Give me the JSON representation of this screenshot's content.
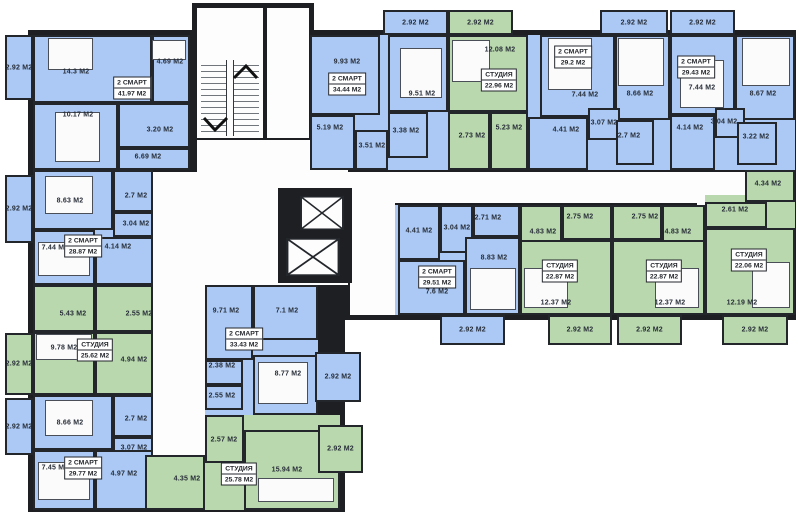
{
  "colors": {
    "two_room_fill": "#abc9f4",
    "studio_fill": "#b9d8ad",
    "wall": "#1d1f23",
    "background": "#ffffff",
    "label_text": "#272d38"
  },
  "unit": "М2",
  "apartments": [
    {
      "type": "2 СМАРТ",
      "area": "41.97 М2",
      "x": 132,
      "y": 88
    },
    {
      "type": "2 СМАРТ",
      "area": "34.44 М2",
      "x": 347,
      "y": 84
    },
    {
      "type": "СТУДИЯ",
      "area": "22.96 М2",
      "x": 499,
      "y": 80
    },
    {
      "type": "2 СМАРТ",
      "area": "29.2 М2",
      "x": 573,
      "y": 57
    },
    {
      "type": "2 СМАРТ",
      "area": "29.43 М2",
      "x": 696,
      "y": 67
    },
    {
      "type": "2 СМАРТ",
      "area": "28.87 М2",
      "x": 83,
      "y": 246
    },
    {
      "type": "СТУДИЯ",
      "area": "25.62 М2",
      "x": 95,
      "y": 350
    },
    {
      "type": "2 СМАРТ",
      "area": "29.77 М2",
      "x": 83,
      "y": 468
    },
    {
      "type": "2 СМАРТ",
      "area": "33.43 М2",
      "x": 244,
      "y": 339
    },
    {
      "type": "СТУДИЯ",
      "area": "25.78 М2",
      "x": 239,
      "y": 474
    },
    {
      "type": "2 СМАРТ",
      "area": "29.51 М2",
      "x": 437,
      "y": 277
    },
    {
      "type": "СТУДИЯ",
      "area": "22.87 М2",
      "x": 560,
      "y": 271
    },
    {
      "type": "СТУДИЯ",
      "area": "22.87 М2",
      "x": 664,
      "y": 271
    },
    {
      "type": "СТУДИЯ",
      "area": "22.06 М2",
      "x": 749,
      "y": 260
    }
  ],
  "rooms": [
    {
      "label": "2.92 М2",
      "x": 5,
      "y": 35,
      "w": 28,
      "h": 65,
      "c": "b",
      "balcony": true
    },
    {
      "label": "14.3 М2",
      "x": 33,
      "y": 35,
      "w": 119,
      "h": 68,
      "c": "b",
      "lx": 76,
      "ly": 72
    },
    {
      "label": "4.69 М2",
      "x": 152,
      "y": 35,
      "w": 38,
      "h": 68,
      "c": "b",
      "lx": 170,
      "ly": 62
    },
    {
      "label": "10.17 М2",
      "x": 33,
      "y": 103,
      "w": 85,
      "h": 67,
      "c": "b",
      "lx": 78,
      "ly": 115
    },
    {
      "label": "3.20 М2",
      "x": 118,
      "y": 103,
      "w": 72,
      "h": 45,
      "c": "b",
      "lx": 160,
      "ly": 130
    },
    {
      "label": "6.69 М2",
      "x": 118,
      "y": 148,
      "w": 72,
      "h": 22,
      "c": "b",
      "lx": 148,
      "ly": 157
    },
    {
      "label": "2.92 М2",
      "x": 383,
      "y": 10,
      "w": 65,
      "h": 25,
      "c": "b",
      "balcony": true
    },
    {
      "label": "9.93 М2",
      "x": 310,
      "y": 35,
      "w": 70,
      "h": 80,
      "c": "b",
      "lx": 347,
      "ly": 62
    },
    {
      "label": "5.19 М2",
      "x": 310,
      "y": 115,
      "w": 45,
      "h": 55,
      "c": "b",
      "lx": 330,
      "ly": 128
    },
    {
      "label": "3.51 М2",
      "x": 355,
      "y": 130,
      "w": 33,
      "h": 40,
      "c": "b",
      "lx": 372,
      "ly": 146
    },
    {
      "label": "3.38 М2",
      "x": 388,
      "y": 112,
      "w": 40,
      "h": 46,
      "c": "b",
      "lx": 406,
      "ly": 131
    },
    {
      "label": "9.51 М2",
      "x": 388,
      "y": 35,
      "w": 60,
      "h": 77,
      "c": "b",
      "lx": 422,
      "ly": 94
    },
    {
      "label": "2.92 М2",
      "x": 448,
      "y": 10,
      "w": 65,
      "h": 25,
      "c": "g",
      "balcony": true
    },
    {
      "label": "12.08 М2",
      "x": 448,
      "y": 35,
      "w": 80,
      "h": 77,
      "c": "g",
      "lx": 500,
      "ly": 50
    },
    {
      "label": "2.73 М2",
      "x": 448,
      "y": 112,
      "w": 42,
      "h": 58,
      "c": "g",
      "lx": 472,
      "ly": 136
    },
    {
      "label": "5.23 М2",
      "x": 490,
      "y": 112,
      "w": 38,
      "h": 58,
      "c": "g",
      "lx": 509,
      "ly": 128
    },
    {
      "label": "2.92 М2",
      "x": 600,
      "y": 10,
      "w": 68,
      "h": 25,
      "c": "b",
      "balcony": true
    },
    {
      "label": "7.44 М2",
      "x": 540,
      "y": 35,
      "w": 75,
      "h": 82,
      "c": "b",
      "lx": 585,
      "ly": 95
    },
    {
      "label": "8.66 М2",
      "x": 615,
      "y": 35,
      "w": 55,
      "h": 85,
      "c": "b",
      "lx": 640,
      "ly": 94
    },
    {
      "label": "4.41 М2",
      "x": 528,
      "y": 117,
      "w": 60,
      "h": 53,
      "c": "b",
      "lx": 566,
      "ly": 130
    },
    {
      "label": "3.07 М2",
      "x": 588,
      "y": 108,
      "w": 32,
      "h": 32,
      "c": "b",
      "lx": 604,
      "ly": 123
    },
    {
      "label": "2.7 М2",
      "x": 616,
      "y": 120,
      "w": 38,
      "h": 45,
      "c": "b",
      "lx": 629,
      "ly": 136
    },
    {
      "label": "2.92 М2",
      "x": 670,
      "y": 10,
      "w": 65,
      "h": 25,
      "c": "b",
      "balcony": true
    },
    {
      "label": "7.44 М2",
      "x": 670,
      "y": 35,
      "w": 65,
      "h": 80,
      "c": "b",
      "lx": 702,
      "ly": 88
    },
    {
      "label": "8.67 М2",
      "x": 735,
      "y": 35,
      "w": 60,
      "h": 85,
      "c": "b",
      "lx": 763,
      "ly": 94
    },
    {
      "label": "4.14 М2",
      "x": 670,
      "y": 115,
      "w": 45,
      "h": 55,
      "c": "b",
      "lx": 690,
      "ly": 128
    },
    {
      "label": "3.04 М2",
      "x": 715,
      "y": 108,
      "w": 30,
      "h": 30,
      "c": "b",
      "lx": 724,
      "ly": 122
    },
    {
      "label": "3.22 М2",
      "x": 737,
      "y": 122,
      "w": 40,
      "h": 43,
      "c": "b",
      "lx": 756,
      "ly": 137
    },
    {
      "label": "2.92 М2",
      "x": 5,
      "y": 175,
      "w": 28,
      "h": 68,
      "c": "b",
      "balcony": true
    },
    {
      "label": "8.63 М2",
      "x": 33,
      "y": 170,
      "w": 80,
      "h": 60,
      "c": "b",
      "lx": 70,
      "ly": 201
    },
    {
      "label": "2.7 М2",
      "x": 113,
      "y": 170,
      "w": 40,
      "h": 42,
      "c": "b",
      "lx": 136,
      "ly": 196
    },
    {
      "label": "3.04 М2",
      "x": 113,
      "y": 212,
      "w": 40,
      "h": 25,
      "c": "b",
      "lx": 136,
      "ly": 224
    },
    {
      "label": "7.44 М2",
      "x": 33,
      "y": 230,
      "w": 62,
      "h": 55,
      "c": "b",
      "lx": 55,
      "ly": 248
    },
    {
      "label": "4.14 М2",
      "x": 95,
      "y": 237,
      "w": 58,
      "h": 48,
      "c": "b",
      "lx": 118,
      "ly": 247
    },
    {
      "label": "5.43 М2",
      "x": 33,
      "y": 285,
      "w": 62,
      "h": 47,
      "c": "g",
      "lx": 73,
      "ly": 314
    },
    {
      "label": "2.55 М2",
      "x": 95,
      "y": 285,
      "w": 58,
      "h": 47,
      "c": "g",
      "lx": 139,
      "ly": 314
    },
    {
      "label": "2.92 М2",
      "x": 5,
      "y": 333,
      "w": 28,
      "h": 62,
      "c": "g",
      "balcony": true
    },
    {
      "label": "9.78 М2",
      "x": 33,
      "y": 332,
      "w": 62,
      "h": 63,
      "c": "g",
      "lx": 64,
      "ly": 348
    },
    {
      "label": "4.94 М2",
      "x": 95,
      "y": 332,
      "w": 58,
      "h": 63,
      "c": "g",
      "lx": 134,
      "ly": 360
    },
    {
      "label": "2.92 М2",
      "x": 5,
      "y": 398,
      "w": 28,
      "h": 57,
      "c": "b",
      "balcony": true
    },
    {
      "label": "8.66 М2",
      "x": 33,
      "y": 395,
      "w": 80,
      "h": 55,
      "c": "b",
      "lx": 70,
      "ly": 423
    },
    {
      "label": "2.7 М2",
      "x": 113,
      "y": 395,
      "w": 40,
      "h": 42,
      "c": "b",
      "lx": 136,
      "ly": 419
    },
    {
      "label": "3.07 М2",
      "x": 113,
      "y": 437,
      "w": 40,
      "h": 26,
      "c": "b",
      "lx": 134,
      "ly": 448
    },
    {
      "label": "7.45 М2",
      "x": 33,
      "y": 450,
      "w": 62,
      "h": 60,
      "c": "b",
      "lx": 55,
      "ly": 468
    },
    {
      "label": "4.97 М2",
      "x": 95,
      "y": 450,
      "w": 58,
      "h": 60,
      "c": "b",
      "lx": 124,
      "ly": 474
    },
    {
      "label": "9.71 М2",
      "x": 205,
      "y": 285,
      "w": 48,
      "h": 75,
      "c": "b",
      "lx": 226,
      "ly": 311
    },
    {
      "label": "7.1 М2",
      "x": 253,
      "y": 285,
      "w": 65,
      "h": 55,
      "c": "b",
      "lx": 287,
      "ly": 311
    },
    {
      "label": "2.38 М2",
      "x": 205,
      "y": 360,
      "w": 38,
      "h": 25,
      "c": "b",
      "lx": 222,
      "ly": 366
    },
    {
      "label": "2.55 М2",
      "x": 205,
      "y": 385,
      "w": 38,
      "h": 25,
      "c": "b",
      "lx": 222,
      "ly": 396
    },
    {
      "label": "8.77 М2",
      "x": 253,
      "y": 355,
      "w": 65,
      "h": 60,
      "c": "b",
      "lx": 288,
      "ly": 374
    },
    {
      "label": "2.92 М2",
      "x": 315,
      "y": 352,
      "w": 46,
      "h": 50,
      "c": "b",
      "balcony": true
    },
    {
      "label": "2.57 М2",
      "x": 205,
      "y": 415,
      "w": 39,
      "h": 48,
      "c": "g",
      "lx": 224,
      "ly": 440
    },
    {
      "label": "15.94 М2",
      "x": 244,
      "y": 430,
      "w": 96,
      "h": 80,
      "c": "g",
      "lx": 287,
      "ly": 470
    },
    {
      "label": "2.92 М2",
      "x": 318,
      "y": 425,
      "w": 45,
      "h": 48,
      "c": "g",
      "balcony": true
    },
    {
      "label": "4.35 М2",
      "x": 145,
      "y": 455,
      "w": 60,
      "h": 55,
      "c": "g",
      "lx": 187,
      "ly": 479
    },
    {
      "label": "4.41 М2",
      "x": 398,
      "y": 205,
      "w": 42,
      "h": 55,
      "c": "b",
      "lx": 419,
      "ly": 231
    },
    {
      "label": "3.04 М2",
      "x": 440,
      "y": 205,
      "w": 33,
      "h": 48,
      "c": "b",
      "lx": 457,
      "ly": 228
    },
    {
      "label": "2.71 М2",
      "x": 473,
      "y": 205,
      "w": 47,
      "h": 32,
      "c": "b",
      "lx": 488,
      "ly": 218
    },
    {
      "label": "8.83 М2",
      "x": 465,
      "y": 237,
      "w": 55,
      "h": 78,
      "c": "b",
      "lx": 494,
      "ly": 258
    },
    {
      "label": "7.6 М2",
      "x": 398,
      "y": 260,
      "w": 67,
      "h": 55,
      "c": "b",
      "lx": 437,
      "ly": 292
    },
    {
      "label": "2.92 М2",
      "x": 440,
      "y": 315,
      "w": 65,
      "h": 30,
      "c": "b",
      "balcony": true
    },
    {
      "label": "4.83 М2",
      "x": 520,
      "y": 205,
      "w": 42,
      "h": 65,
      "c": "g",
      "lx": 543,
      "ly": 232
    },
    {
      "label": "2.75 М2",
      "x": 562,
      "y": 205,
      "w": 50,
      "h": 35,
      "c": "g",
      "lx": 580,
      "ly": 217
    },
    {
      "label": "12.37 М2",
      "x": 520,
      "y": 240,
      "w": 92,
      "h": 75,
      "c": "g",
      "lx": 556,
      "ly": 303
    },
    {
      "label": "2.92 М2",
      "x": 548,
      "y": 315,
      "w": 64,
      "h": 30,
      "c": "g",
      "balcony": true
    },
    {
      "label": "2.75 М2",
      "x": 612,
      "y": 205,
      "w": 50,
      "h": 35,
      "c": "g",
      "lx": 645,
      "ly": 217
    },
    {
      "label": "4.83 М2",
      "x": 662,
      "y": 205,
      "w": 43,
      "h": 65,
      "c": "g",
      "lx": 678,
      "ly": 232
    },
    {
      "label": "12.37 М2",
      "x": 612,
      "y": 240,
      "w": 93,
      "h": 75,
      "c": "g",
      "lx": 670,
      "ly": 303
    },
    {
      "label": "2.92 М2",
      "x": 617,
      "y": 315,
      "w": 65,
      "h": 30,
      "c": "g",
      "balcony": true
    },
    {
      "label": "4.34 М2",
      "x": 745,
      "y": 170,
      "w": 50,
      "h": 32,
      "c": "g",
      "lx": 768,
      "ly": 184
    },
    {
      "label": "2.61 М2",
      "x": 705,
      "y": 202,
      "w": 62,
      "h": 26,
      "c": "g",
      "lx": 735,
      "ly": 210
    },
    {
      "label": "12.19 М2",
      "x": 705,
      "y": 228,
      "w": 90,
      "h": 87,
      "c": "g",
      "lx": 742,
      "ly": 303
    },
    {
      "label": "2.92 М2",
      "x": 722,
      "y": 315,
      "w": 66,
      "h": 30,
      "c": "g",
      "balcony": true
    }
  ],
  "apartment_blocks": [
    {
      "x": 33,
      "y": 35,
      "w": 157,
      "h": 135,
      "c": "b"
    },
    {
      "x": 310,
      "y": 35,
      "w": 138,
      "h": 135,
      "c": "b"
    },
    {
      "x": 448,
      "y": 35,
      "w": 80,
      "h": 135,
      "c": "g"
    },
    {
      "x": 528,
      "y": 35,
      "w": 142,
      "h": 135,
      "c": "b"
    },
    {
      "x": 670,
      "y": 35,
      "w": 125,
      "h": 135,
      "c": "b"
    },
    {
      "x": 33,
      "y": 170,
      "w": 120,
      "h": 115,
      "c": "b"
    },
    {
      "x": 33,
      "y": 285,
      "w": 120,
      "h": 110,
      "c": "g"
    },
    {
      "x": 33,
      "y": 395,
      "w": 120,
      "h": 115,
      "c": "b"
    },
    {
      "x": 205,
      "y": 285,
      "w": 113,
      "h": 130,
      "c": "b"
    },
    {
      "x": 205,
      "y": 415,
      "w": 135,
      "h": 95,
      "c": "g"
    },
    {
      "x": 395,
      "y": 205,
      "w": 125,
      "h": 110,
      "c": "b"
    },
    {
      "x": 520,
      "y": 205,
      "w": 92,
      "h": 110,
      "c": "g"
    },
    {
      "x": 612,
      "y": 205,
      "w": 93,
      "h": 110,
      "c": "g"
    },
    {
      "x": 705,
      "y": 195,
      "w": 90,
      "h": 120,
      "c": "g"
    }
  ],
  "structure": {
    "outer_walls": [
      {
        "x": 28,
        "y": 30,
        "w": 768,
        "h": 290
      },
      {
        "x": 28,
        "y": 170,
        "w": 177,
        "h": 342
      },
      {
        "x": 200,
        "y": 283,
        "w": 145,
        "h": 229
      },
      {
        "x": 192,
        "y": 3,
        "w": 76,
        "h": 140
      },
      {
        "x": 262,
        "y": 3,
        "w": 52,
        "h": 140
      }
    ],
    "corridors": [
      {
        "x": 197,
        "y": 8,
        "w": 66,
        "h": 130
      },
      {
        "x": 267,
        "y": 8,
        "w": 42,
        "h": 130
      },
      {
        "x": 153,
        "y": 172,
        "w": 52,
        "h": 283
      },
      {
        "x": 197,
        "y": 140,
        "w": 151,
        "h": 145
      },
      {
        "x": 348,
        "y": 172,
        "w": 398,
        "h": 31
      },
      {
        "x": 350,
        "y": 203,
        "w": 45,
        "h": 112
      },
      {
        "x": 697,
        "y": 203,
        "w": 25,
        "h": 112
      }
    ]
  },
  "furniture": [
    {
      "x": 48,
      "y": 38,
      "w": 45,
      "h": 32
    },
    {
      "x": 55,
      "y": 112,
      "w": 45,
      "h": 50
    },
    {
      "x": 152,
      "y": 40,
      "w": 34,
      "h": 20
    },
    {
      "x": 45,
      "y": 176,
      "w": 48,
      "h": 38
    },
    {
      "x": 38,
      "y": 242,
      "w": 52,
      "h": 34
    },
    {
      "x": 36,
      "y": 334,
      "w": 56,
      "h": 26
    },
    {
      "x": 45,
      "y": 400,
      "w": 48,
      "h": 36
    },
    {
      "x": 38,
      "y": 462,
      "w": 52,
      "h": 38
    },
    {
      "x": 400,
      "y": 48,
      "w": 42,
      "h": 50
    },
    {
      "x": 452,
      "y": 40,
      "w": 38,
      "h": 42
    },
    {
      "x": 548,
      "y": 38,
      "w": 44,
      "h": 52
    },
    {
      "x": 618,
      "y": 38,
      "w": 46,
      "h": 48
    },
    {
      "x": 680,
      "y": 60,
      "w": 44,
      "h": 48
    },
    {
      "x": 742,
      "y": 38,
      "w": 48,
      "h": 48
    },
    {
      "x": 470,
      "y": 268,
      "w": 46,
      "h": 42
    },
    {
      "x": 258,
      "y": 362,
      "w": 50,
      "h": 42
    },
    {
      "x": 258,
      "y": 478,
      "w": 76,
      "h": 24
    },
    {
      "x": 524,
      "y": 268,
      "w": 44,
      "h": 40
    },
    {
      "x": 655,
      "y": 268,
      "w": 44,
      "h": 40
    },
    {
      "x": 752,
      "y": 262,
      "w": 38,
      "h": 46
    }
  ]
}
